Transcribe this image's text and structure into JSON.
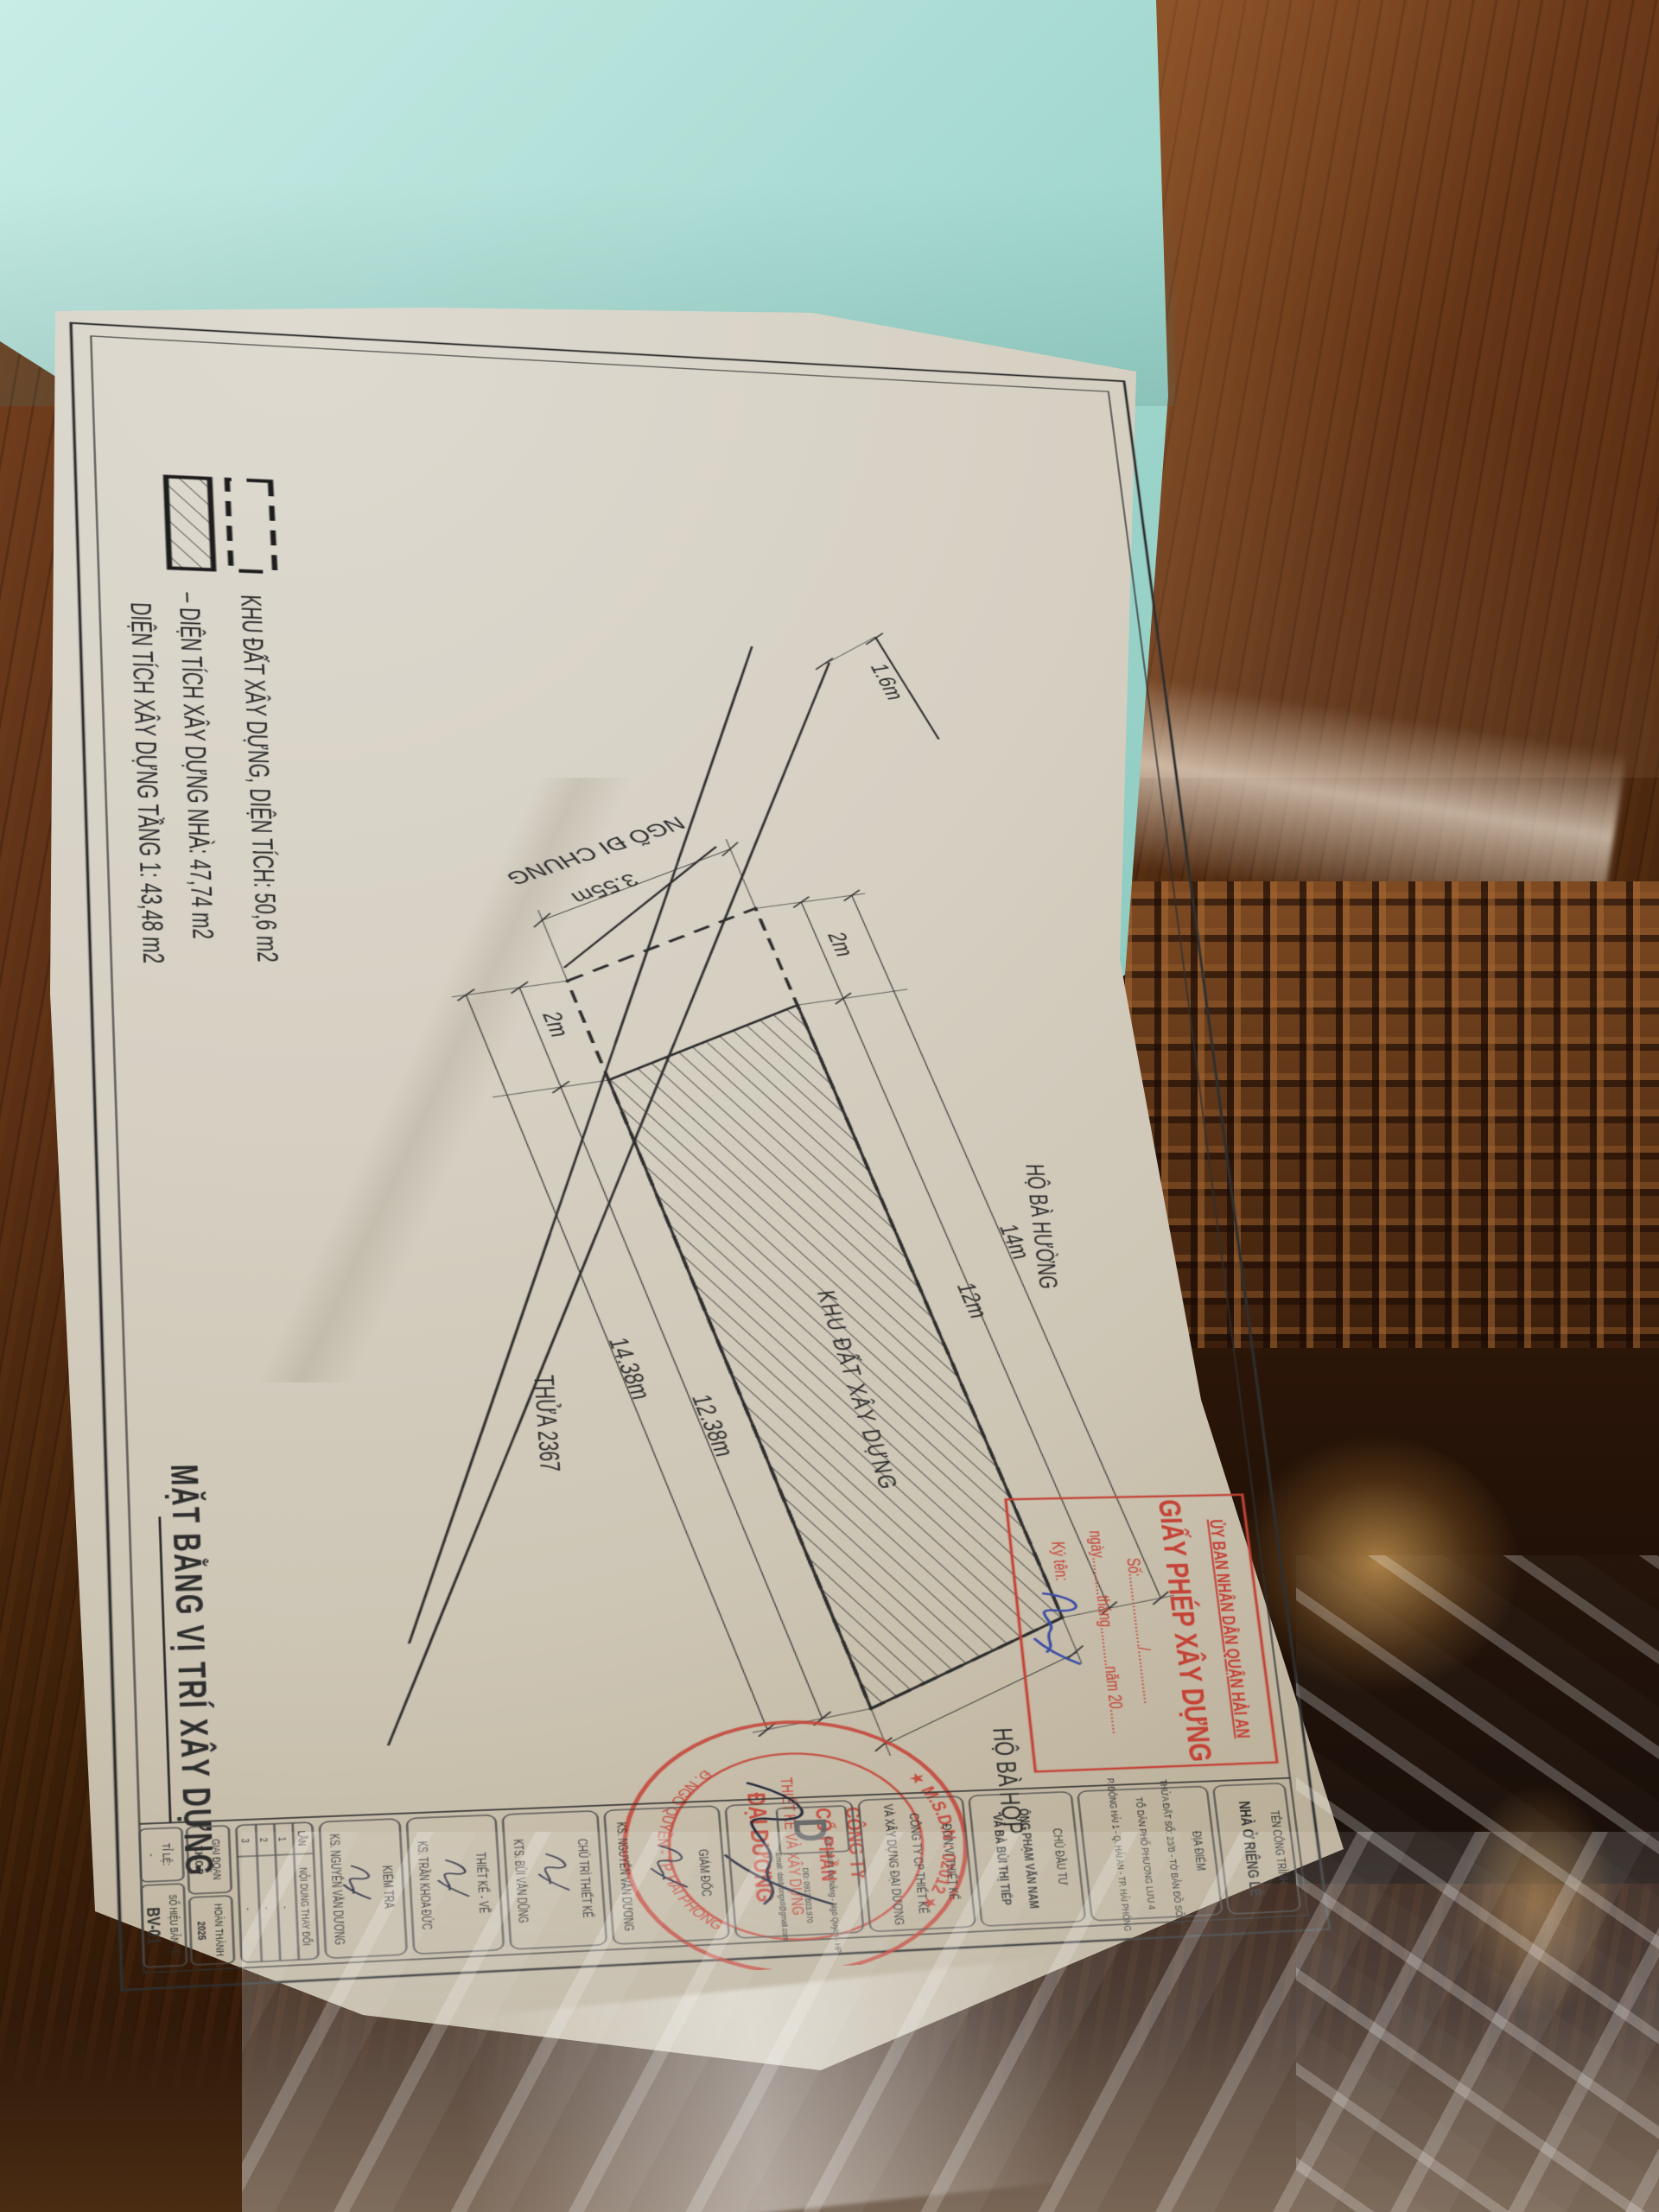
{
  "legend": {
    "row1": "KHU ĐẤT XÂY DỰNG, DIỆN TÍCH: 50,6 m2",
    "row2": "– DIỆN TÍCH XÂY DỰNG NHÀ: 47,74 m2",
    "row3": "DIỆN TÍCH XÂY DỰNG TẦNG 1: 43,48 m2"
  },
  "plan": {
    "alley_label": "NGÕ ĐI CHUNG",
    "labels": {
      "parcel": "KHU ĐẤT XÂY DỰNG",
      "neighbor_right": "HỘ BÀ HƯỜNG",
      "neighbor_end": "HỘ BÀ HỢP",
      "lot_number": "THỬA 2367"
    },
    "dims": {
      "frontage": "3.55m",
      "alley_end": "1.6m",
      "setback_ne": "2m",
      "setback_sw": "2m",
      "length_total_ne": "14m",
      "length_house_ne": "12m",
      "length_total_sw": "14.38m",
      "length_house_sw": "12.38m"
    }
  },
  "permit_box": {
    "line1": "ỦY BAN NHÂN DÂN QUẬN HẢI AN",
    "line2": "GIẤY PHÉP XÂY DỰNG",
    "line3": "Số:..................../...............",
    "line4": "ngày...........tháng...........năm 20.......",
    "line5": "Ký tên:"
  },
  "stamp": {
    "arc_top": "★ M.S.D.N : 02012 ★",
    "company_1": "CÔNG TY",
    "company_2": "CỔ PHẦN",
    "company_3": "THIẾT KẾ VÀ XÂY DỰNG",
    "company_4": "ĐẠI DƯƠNG",
    "arc_bottom": "Đ. NGÔ QUYỀN - TP. HẢI PHÒNG"
  },
  "title_block": {
    "project_label": "TÊN CÔNG TRÌNH",
    "project_value": "NHÀ Ở RIÊNG LẺ",
    "location_label": "ĐỊA ĐIỂM",
    "location_line1": "THỬA ĐẤT SỐ: 23/B - TỜ BẢN ĐỒ SỐ: 2",
    "location_line2": "TỔ DÂN PHỐ PHƯƠNG LƯU 4",
    "location_line3": "P. ĐÔNG HẢI 1 - Q. HẢI AN - TP. HẢI PHÒNG",
    "investor_label": "CHỦ ĐẦU TƯ",
    "investor_line1": "ÔNG PHẠM VĂN NAM",
    "investor_line2": "VÀ BÀ BÙI THỊ TIẾP",
    "designer_label": "ĐƠN VỊ THIẾT KẾ",
    "designer_line1": "CÔNG TY CP THIẾT KẾ",
    "designer_line2": "VÀ XÂY DỰNG ĐẠI DƯƠNG",
    "logo_letter": "D",
    "contact_line1": "Đ/C: 34/81 Đà Nẵng - Ngô Quyền - HP",
    "contact_line2": "DĐ: 0913.603.970",
    "contact_line3": "Email: daiduongxd@gmail.com",
    "director_label": "GIÁM ĐỐC",
    "director_name": "KS. NGUYỄN VĂN DƯƠNG",
    "chief_label": "CHỦ TRÌ THIẾT KẾ",
    "chief_name": "KTS. BÙI VĂN DŨNG",
    "drafter_label": "THIẾT KẾ - VẼ",
    "drafter_name": "KS. TRẦN KHOA ĐỨC",
    "checker_label": "KIỂM TRA",
    "checker_name": "KS. NGUYỄN VĂN DƯƠNG",
    "rev_col1": "LẦN",
    "rev_col2": "NỘI DUNG THAY ĐỔI",
    "rev_r1n": "1",
    "rev_r1v": "-",
    "rev_r2n": "2",
    "rev_r2v": "-",
    "rev_r3n": "3",
    "rev_r3v": "-",
    "stage_label": "GIAI ĐOẠN",
    "stage_value": "T.K.C.P",
    "finish_label": "HOÀN THÀNH",
    "finish_value": "2025",
    "scale_label": "TỈ LỆ:",
    "scale_value": "-",
    "sheet_label": "SỐ HIỆU BẢN VẼ",
    "sheet_value": "BV-01",
    "drawing_name_1": "MẶT BẰNG",
    "drawing_name_2": "VỊ TRÍ XÂY DỰNG"
  },
  "big_title": "MẶT BẰNG VỊ TRÍ XÂY DỰNG",
  "colors": {
    "ink": "#2e2e2e",
    "stamp_red": "#c44236",
    "signature_blue": "#3b4da5",
    "paper": "#d6d0c3",
    "teal": "#b2e0d8"
  }
}
